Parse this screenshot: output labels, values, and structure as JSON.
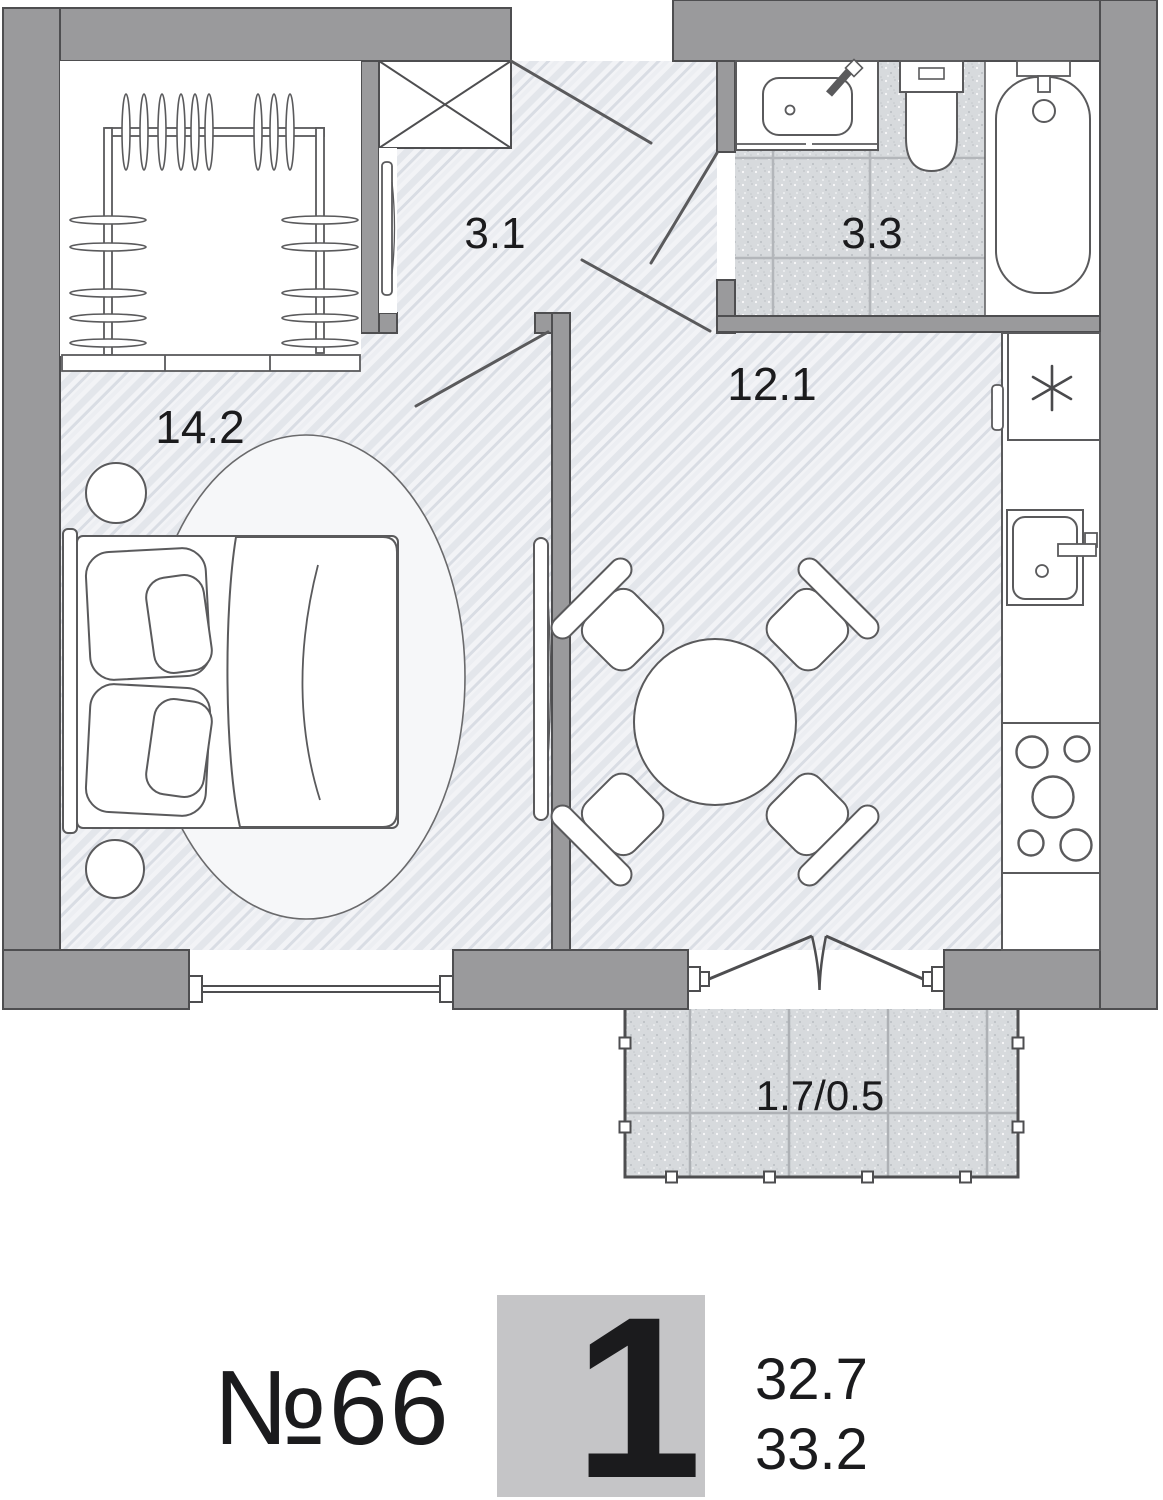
{
  "plan": {
    "room_labels": {
      "hallway": "3.1",
      "bathroom": "3.3",
      "bedroom": "14.2",
      "kitchen_living": "12.1",
      "balcony": "1.7/0.5"
    }
  },
  "legend": {
    "apartment_number": "№66",
    "room_count": "1",
    "area_upper": "32.7",
    "area_lower": "33.2"
  },
  "colors": {
    "wall": "#9a9a9c",
    "outline": "#4e4e50",
    "floor": "#f2f3f6",
    "hatch_stroke": "#dde1e7",
    "tile": "#d7dadd",
    "tile_grid": "#b3b6ba",
    "furniture_stroke": "#5a5a5c",
    "legend_square": "#c5c5c7",
    "legend_digit": "#f1f1f3",
    "text": "#1b1b1d"
  },
  "icons": {
    "refrigerator": "snowflake-asterisk",
    "shaft": "crossed-box"
  }
}
